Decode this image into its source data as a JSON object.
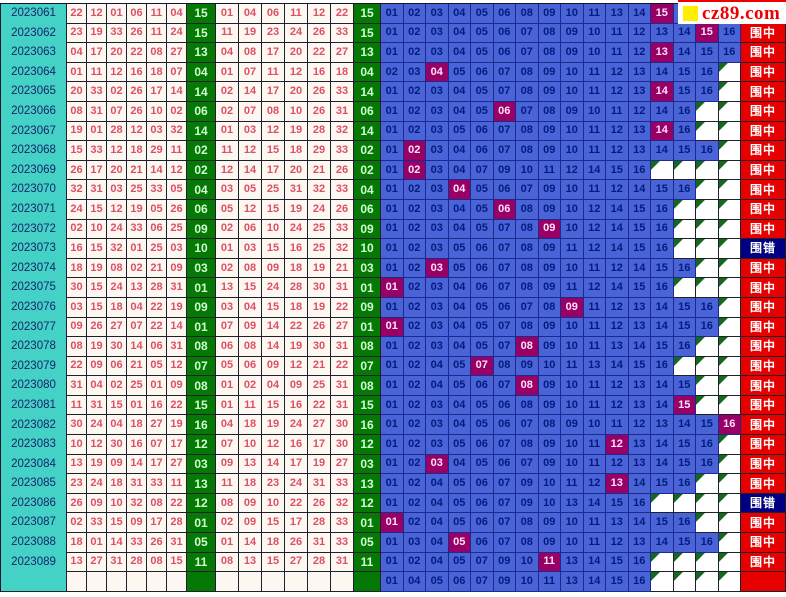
{
  "logo": {
    "text": "cz89.com"
  },
  "labels": {
    "hit": "围中",
    "miss": "围错"
  },
  "colors": {
    "period_bg": "#44d2c6",
    "red_ball": "#dc5064",
    "green_bg": "#067806",
    "green_text": "#ccffcc",
    "trend_bg": "#4a63d6",
    "trend_text": "#001d7e",
    "hit_cell_bg": "#990066",
    "result_hit_bg": "#e60000",
    "result_miss_bg": "#000080",
    "logo_accent": "#ffee00"
  },
  "chart_data": {
    "type": "table",
    "columns": [
      "period",
      "drawn red balls (6)",
      "blue ball",
      "sorted red balls (6)",
      "blue ball",
      "predicted blue range 01-16 (hit highlighted)",
      "result"
    ],
    "rows": [
      {
        "period": "2023061",
        "drawn": [
          "22",
          "12",
          "01",
          "06",
          "11",
          "04"
        ],
        "blue": "15",
        "sorted": [
          "01",
          "04",
          "06",
          "11",
          "12",
          "22"
        ],
        "trend": [
          "01",
          "02",
          "03",
          "04",
          "05",
          "06",
          "08",
          "09",
          "10",
          "11",
          "13",
          "14",
          "15",
          "16"
        ],
        "result": ""
      },
      {
        "period": "2023062",
        "drawn": [
          "23",
          "19",
          "33",
          "26",
          "11",
          "24"
        ],
        "blue": "15",
        "sorted": [
          "11",
          "19",
          "23",
          "24",
          "26",
          "33"
        ],
        "trend": [
          "01",
          "02",
          "03",
          "04",
          "05",
          "06",
          "07",
          "08",
          "09",
          "10",
          "11",
          "12",
          "13",
          "14",
          "15",
          "16"
        ],
        "result": "hit"
      },
      {
        "period": "2023063",
        "drawn": [
          "04",
          "17",
          "20",
          "22",
          "08",
          "27"
        ],
        "blue": "13",
        "sorted": [
          "04",
          "08",
          "17",
          "20",
          "22",
          "27"
        ],
        "trend": [
          "01",
          "02",
          "03",
          "04",
          "05",
          "06",
          "07",
          "08",
          "09",
          "10",
          "11",
          "12",
          "13",
          "14",
          "15",
          "16"
        ],
        "result": "hit"
      },
      {
        "period": "2023064",
        "drawn": [
          "01",
          "11",
          "12",
          "16",
          "18",
          "07"
        ],
        "blue": "04",
        "sorted": [
          "01",
          "07",
          "11",
          "12",
          "16",
          "18"
        ],
        "trend": [
          "02",
          "03",
          "04",
          "05",
          "06",
          "07",
          "08",
          "09",
          "10",
          "11",
          "12",
          "13",
          "14",
          "15",
          "16"
        ],
        "result": "hit"
      },
      {
        "period": "2023065",
        "drawn": [
          "20",
          "33",
          "02",
          "26",
          "17",
          "14"
        ],
        "blue": "14",
        "sorted": [
          "02",
          "14",
          "17",
          "20",
          "26",
          "33"
        ],
        "trend": [
          "01",
          "02",
          "03",
          "04",
          "05",
          "07",
          "08",
          "09",
          "10",
          "11",
          "12",
          "13",
          "14",
          "15",
          "16"
        ],
        "result": "hit"
      },
      {
        "period": "2023066",
        "drawn": [
          "08",
          "31",
          "07",
          "26",
          "10",
          "02"
        ],
        "blue": "06",
        "sorted": [
          "02",
          "07",
          "08",
          "10",
          "26",
          "31"
        ],
        "trend": [
          "01",
          "02",
          "03",
          "04",
          "05",
          "06",
          "07",
          "08",
          "09",
          "10",
          "11",
          "12",
          "14",
          "16"
        ],
        "result": "hit"
      },
      {
        "period": "2023067",
        "drawn": [
          "19",
          "01",
          "28",
          "12",
          "03",
          "32"
        ],
        "blue": "14",
        "sorted": [
          "01",
          "03",
          "12",
          "19",
          "28",
          "32"
        ],
        "trend": [
          "01",
          "02",
          "03",
          "05",
          "06",
          "07",
          "08",
          "09",
          "10",
          "11",
          "12",
          "13",
          "14",
          "16"
        ],
        "result": "hit"
      },
      {
        "period": "2023068",
        "drawn": [
          "15",
          "33",
          "12",
          "18",
          "29",
          "11"
        ],
        "blue": "02",
        "sorted": [
          "11",
          "12",
          "15",
          "18",
          "29",
          "33"
        ],
        "trend": [
          "01",
          "02",
          "03",
          "04",
          "06",
          "07",
          "08",
          "09",
          "10",
          "11",
          "12",
          "13",
          "14",
          "15",
          "16"
        ],
        "result": "hit"
      },
      {
        "period": "2023069",
        "drawn": [
          "26",
          "17",
          "20",
          "21",
          "14",
          "12"
        ],
        "blue": "02",
        "sorted": [
          "12",
          "14",
          "17",
          "20",
          "21",
          "26"
        ],
        "trend": [
          "01",
          "02",
          "03",
          "04",
          "07",
          "09",
          "10",
          "11",
          "12",
          "14",
          "15",
          "16"
        ],
        "result": "hit"
      },
      {
        "period": "2023070",
        "drawn": [
          "32",
          "31",
          "03",
          "25",
          "33",
          "05"
        ],
        "blue": "04",
        "sorted": [
          "03",
          "05",
          "25",
          "31",
          "32",
          "33"
        ],
        "trend": [
          "01",
          "02",
          "03",
          "04",
          "05",
          "06",
          "07",
          "09",
          "10",
          "11",
          "12",
          "14",
          "15",
          "16"
        ],
        "result": "hit"
      },
      {
        "period": "2023071",
        "drawn": [
          "24",
          "15",
          "12",
          "19",
          "05",
          "26"
        ],
        "blue": "06",
        "sorted": [
          "05",
          "12",
          "15",
          "19",
          "24",
          "26"
        ],
        "trend": [
          "01",
          "02",
          "03",
          "04",
          "05",
          "06",
          "08",
          "09",
          "10",
          "12",
          "14",
          "15",
          "16"
        ],
        "result": "hit"
      },
      {
        "period": "2023072",
        "drawn": [
          "02",
          "10",
          "24",
          "33",
          "06",
          "25"
        ],
        "blue": "09",
        "sorted": [
          "02",
          "06",
          "10",
          "24",
          "25",
          "33"
        ],
        "trend": [
          "01",
          "02",
          "03",
          "04",
          "05",
          "07",
          "08",
          "09",
          "10",
          "12",
          "14",
          "15",
          "16"
        ],
        "result": "hit"
      },
      {
        "period": "2023073",
        "drawn": [
          "16",
          "15",
          "32",
          "01",
          "25",
          "03"
        ],
        "blue": "10",
        "sorted": [
          "01",
          "03",
          "15",
          "16",
          "25",
          "32"
        ],
        "trend": [
          "01",
          "02",
          "03",
          "05",
          "06",
          "07",
          "08",
          "09",
          "11",
          "12",
          "14",
          "15",
          "16"
        ],
        "result": "miss"
      },
      {
        "period": "2023074",
        "drawn": [
          "18",
          "19",
          "08",
          "02",
          "21",
          "09"
        ],
        "blue": "03",
        "sorted": [
          "02",
          "08",
          "09",
          "18",
          "19",
          "21"
        ],
        "trend": [
          "01",
          "02",
          "03",
          "05",
          "06",
          "07",
          "08",
          "09",
          "10",
          "11",
          "12",
          "14",
          "15",
          "16"
        ],
        "result": "hit"
      },
      {
        "period": "2023075",
        "drawn": [
          "30",
          "15",
          "24",
          "13",
          "28",
          "31"
        ],
        "blue": "01",
        "sorted": [
          "13",
          "15",
          "24",
          "28",
          "30",
          "31"
        ],
        "trend": [
          "01",
          "02",
          "03",
          "04",
          "06",
          "07",
          "08",
          "09",
          "11",
          "12",
          "14",
          "15",
          "16"
        ],
        "result": "hit"
      },
      {
        "period": "2023076",
        "drawn": [
          "03",
          "15",
          "18",
          "04",
          "22",
          "19"
        ],
        "blue": "09",
        "sorted": [
          "03",
          "04",
          "15",
          "18",
          "19",
          "22"
        ],
        "trend": [
          "01",
          "02",
          "03",
          "04",
          "05",
          "06",
          "07",
          "08",
          "09",
          "11",
          "12",
          "13",
          "14",
          "15",
          "16"
        ],
        "result": "hit"
      },
      {
        "period": "2023077",
        "drawn": [
          "09",
          "26",
          "27",
          "07",
          "22",
          "14"
        ],
        "blue": "01",
        "sorted": [
          "07",
          "09",
          "14",
          "22",
          "26",
          "27"
        ],
        "trend": [
          "01",
          "02",
          "03",
          "04",
          "05",
          "07",
          "08",
          "09",
          "10",
          "11",
          "12",
          "13",
          "14",
          "15",
          "16"
        ],
        "result": "hit"
      },
      {
        "period": "2023078",
        "drawn": [
          "08",
          "19",
          "30",
          "14",
          "06",
          "31"
        ],
        "blue": "08",
        "sorted": [
          "06",
          "08",
          "14",
          "19",
          "30",
          "31"
        ],
        "trend": [
          "01",
          "02",
          "03",
          "04",
          "05",
          "07",
          "08",
          "09",
          "10",
          "11",
          "13",
          "14",
          "15",
          "16"
        ],
        "result": "hit"
      },
      {
        "period": "2023079",
        "drawn": [
          "22",
          "09",
          "06",
          "21",
          "05",
          "12"
        ],
        "blue": "07",
        "sorted": [
          "05",
          "06",
          "09",
          "12",
          "21",
          "22"
        ],
        "trend": [
          "01",
          "02",
          "04",
          "05",
          "07",
          "08",
          "09",
          "10",
          "11",
          "13",
          "14",
          "15",
          "16"
        ],
        "result": "hit"
      },
      {
        "period": "2023080",
        "drawn": [
          "31",
          "04",
          "02",
          "25",
          "01",
          "09"
        ],
        "blue": "08",
        "sorted": [
          "01",
          "02",
          "04",
          "09",
          "25",
          "31"
        ],
        "trend": [
          "01",
          "02",
          "04",
          "05",
          "06",
          "07",
          "08",
          "09",
          "10",
          "11",
          "12",
          "13",
          "14",
          "15"
        ],
        "result": "hit"
      },
      {
        "period": "2023081",
        "drawn": [
          "11",
          "31",
          "15",
          "01",
          "16",
          "22"
        ],
        "blue": "15",
        "sorted": [
          "01",
          "11",
          "15",
          "16",
          "22",
          "31"
        ],
        "trend": [
          "01",
          "02",
          "03",
          "04",
          "05",
          "06",
          "08",
          "09",
          "10",
          "11",
          "12",
          "13",
          "14",
          "15"
        ],
        "result": "hit"
      },
      {
        "period": "2023082",
        "drawn": [
          "30",
          "24",
          "04",
          "18",
          "27",
          "19"
        ],
        "blue": "16",
        "sorted": [
          "04",
          "18",
          "19",
          "24",
          "27",
          "30"
        ],
        "trend": [
          "01",
          "02",
          "03",
          "04",
          "05",
          "06",
          "07",
          "08",
          "09",
          "10",
          "11",
          "12",
          "13",
          "14",
          "15",
          "16"
        ],
        "result": "hit"
      },
      {
        "period": "2023083",
        "drawn": [
          "10",
          "12",
          "30",
          "16",
          "07",
          "17"
        ],
        "blue": "12",
        "sorted": [
          "07",
          "10",
          "12",
          "16",
          "17",
          "30"
        ],
        "trend": [
          "01",
          "02",
          "03",
          "05",
          "06",
          "07",
          "08",
          "09",
          "10",
          "11",
          "12",
          "13",
          "14",
          "15",
          "16"
        ],
        "result": "hit"
      },
      {
        "period": "2023084",
        "drawn": [
          "13",
          "19",
          "09",
          "14",
          "17",
          "27"
        ],
        "blue": "03",
        "sorted": [
          "09",
          "13",
          "14",
          "17",
          "19",
          "27"
        ],
        "trend": [
          "01",
          "02",
          "03",
          "04",
          "05",
          "06",
          "07",
          "09",
          "10",
          "11",
          "12",
          "13",
          "14",
          "15",
          "16"
        ],
        "result": "hit"
      },
      {
        "period": "2023085",
        "drawn": [
          "23",
          "24",
          "18",
          "31",
          "33",
          "11"
        ],
        "blue": "13",
        "sorted": [
          "11",
          "18",
          "23",
          "24",
          "31",
          "33"
        ],
        "trend": [
          "01",
          "02",
          "04",
          "05",
          "06",
          "07",
          "09",
          "10",
          "11",
          "12",
          "13",
          "14",
          "15",
          "16"
        ],
        "result": "hit"
      },
      {
        "period": "2023086",
        "drawn": [
          "26",
          "09",
          "10",
          "32",
          "08",
          "22"
        ],
        "blue": "12",
        "sorted": [
          "08",
          "09",
          "10",
          "22",
          "26",
          "32"
        ],
        "trend": [
          "01",
          "02",
          "04",
          "05",
          "06",
          "07",
          "09",
          "10",
          "13",
          "14",
          "15",
          "16"
        ],
        "result": "miss"
      },
      {
        "period": "2023087",
        "drawn": [
          "02",
          "33",
          "15",
          "09",
          "17",
          "28"
        ],
        "blue": "01",
        "sorted": [
          "02",
          "09",
          "15",
          "17",
          "28",
          "33"
        ],
        "trend": [
          "01",
          "02",
          "04",
          "05",
          "06",
          "07",
          "08",
          "09",
          "10",
          "11",
          "13",
          "14",
          "15",
          "16"
        ],
        "result": "hit"
      },
      {
        "period": "2023088",
        "drawn": [
          "18",
          "01",
          "14",
          "33",
          "26",
          "31"
        ],
        "blue": "05",
        "sorted": [
          "01",
          "14",
          "18",
          "26",
          "31",
          "33"
        ],
        "trend": [
          "01",
          "03",
          "04",
          "05",
          "06",
          "07",
          "08",
          "09",
          "10",
          "11",
          "12",
          "13",
          "14",
          "15",
          "16"
        ],
        "result": "hit"
      },
      {
        "period": "2023089",
        "drawn": [
          "13",
          "27",
          "31",
          "28",
          "08",
          "15"
        ],
        "blue": "11",
        "sorted": [
          "08",
          "13",
          "15",
          "27",
          "28",
          "31"
        ],
        "trend": [
          "01",
          "02",
          "04",
          "05",
          "07",
          "09",
          "10",
          "11",
          "13",
          "14",
          "15",
          "16"
        ],
        "result": "hit"
      },
      {
        "period": "",
        "drawn": [
          "",
          "",
          "",
          "",
          "",
          ""
        ],
        "blue": "",
        "sorted": [
          "",
          "",
          "",
          "",
          "",
          ""
        ],
        "trend": [
          "01",
          "04",
          "05",
          "06",
          "07",
          "09",
          "10",
          "11",
          "13",
          "14",
          "15",
          "16"
        ],
        "result": ""
      }
    ]
  }
}
